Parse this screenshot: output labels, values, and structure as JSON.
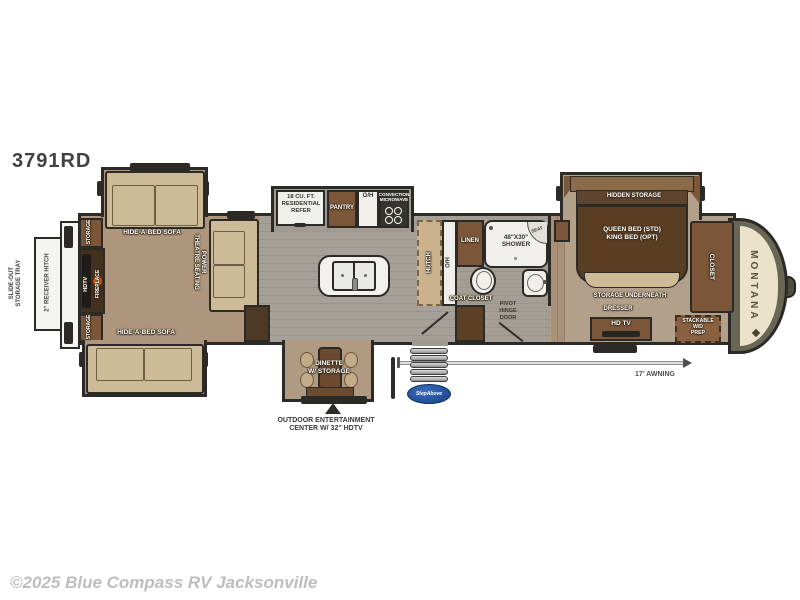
{
  "title": "3791RD",
  "footer": {
    "copyright": "©2025 Blue Compass RV Jacksonville"
  },
  "colors": {
    "carpet": "#ad967c",
    "plank_floor": "#a09a92",
    "bedroom_floor": "#b2a08a",
    "furniture_tan": "#cdbb98",
    "cabinet_brown": "#7b5639",
    "dark_brown": "#5a3e24",
    "wall": "#2b2a26",
    "fixture_white": "#f0efec",
    "front_cap_olive": "#6a6655",
    "front_cap_cream": "#ebe2ca",
    "step_logo_blue": "#16407e"
  },
  "rear": {
    "tray_label": "SLIDE-OUT\nSTORAGE TRAY",
    "hitch_label": "2\" RECEIVER HITCH",
    "storage_top": "STORAGE",
    "storage_bottom": "STORAGE",
    "hdtv": "HDTV",
    "fireplace": "FIREPLACE"
  },
  "living": {
    "sofa_top": "HIDE-A-BED SOFA",
    "sofa_bottom": "HIDE-A-BED SOFA",
    "theatre": "POWER\nTHEATRE SEATING"
  },
  "kitchen": {
    "refer": "18 CU. FT.\nRESIDENTIAL\nREFER",
    "pantry": "PANTRY",
    "overhead": "O/H",
    "microwave": "CONVECTION\nMICROWAVE",
    "hutch": "HUTCH",
    "hutch_overhead": "O/H"
  },
  "dinette": {
    "label": "DINETTE\nW/ STORAGE",
    "outdoor_center": "OUTDOOR ENTERTAINMENT\nCENTER W/ 32\" HDTV"
  },
  "bath": {
    "linen": "LINEN",
    "shower": "48\"X30\"\nSHOWER",
    "seat": "SEAT",
    "coat_closet": "COAT CLOSET",
    "pivot_door": "PIVOT\nHINGE\nDOOR"
  },
  "bedroom": {
    "hidden_storage": "HIDDEN STORAGE",
    "bed": "QUEEN BED (STD)\nKING BED (OPT)",
    "storage_underneath": "STORAGE UNDERNEATH",
    "dresser": "DRESSER",
    "tv": "HD TV",
    "closet": "CLOSET",
    "washer_dryer": "STACKABLE\nW/D\nPREP"
  },
  "front": {
    "brand": "MONTANA"
  },
  "exterior": {
    "awning": "17' AWNING",
    "entry_step_logo": "StepAbove"
  }
}
